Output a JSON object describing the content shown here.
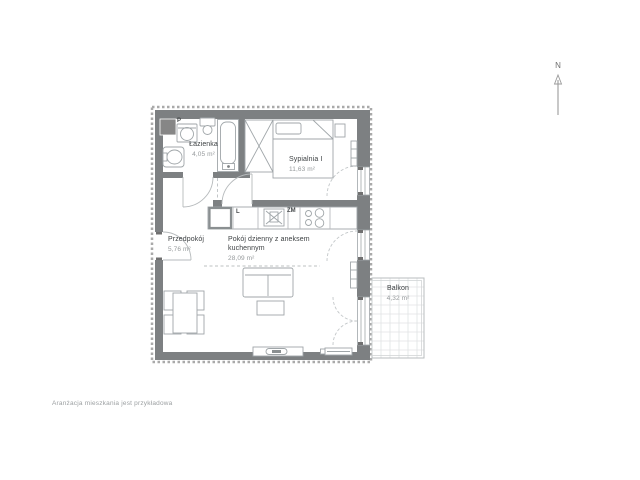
{
  "page": {
    "footer_note": "Aranżacja mieszkania jest przykładowa",
    "compass_label": "N"
  },
  "rooms": {
    "bathroom": {
      "name": "Łazienka",
      "area": "4,05 m²"
    },
    "bedroom": {
      "name": "Sypialnia I",
      "area": "11,63 m²"
    },
    "hall": {
      "name": "Przedpokój",
      "area": "5,76 m²"
    },
    "living": {
      "name_line1": "Pokój dzienny z aneksem",
      "name_line2": "kuchennym",
      "area": "28,09 m²"
    },
    "balcony": {
      "name": "Balkon",
      "area": "4,32 m²"
    }
  },
  "appliance_labels": {
    "washing_machine": "P",
    "fridge": "L",
    "dishwasher": "ZM"
  },
  "colors": {
    "wall": "#7d8082",
    "furniture_line": "#a0a6a9",
    "dashed_line": "#bcc0c2",
    "text_dark": "#3d4143",
    "text_muted": "#969a9c"
  }
}
